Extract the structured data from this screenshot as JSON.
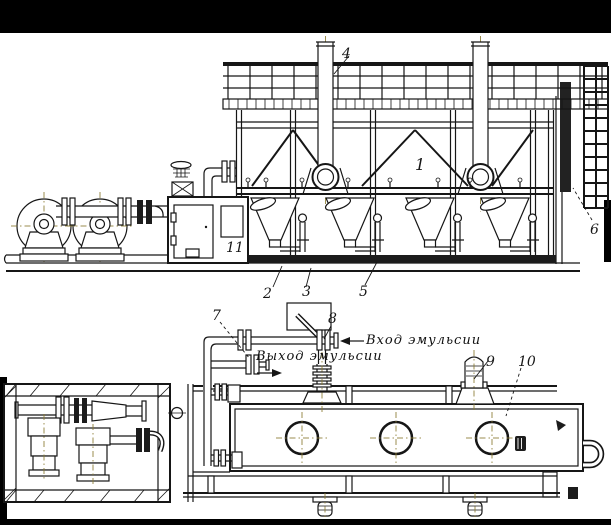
{
  "figure": {
    "type": "scanned-technical-drawing",
    "description": "Two-view engineering drawing of an emulsion cooling installation: side elevation (top) and plan view (bottom)",
    "callouts": [
      {
        "num": "1"
      },
      {
        "num": "2"
      },
      {
        "num": "3"
      },
      {
        "num": "4"
      },
      {
        "num": "5"
      },
      {
        "num": "6"
      },
      {
        "num": "7"
      },
      {
        "num": "8"
      },
      {
        "num": "9"
      },
      {
        "num": "10"
      },
      {
        "num": "11"
      }
    ],
    "annotations": {
      "inlet": "Вход эмульсии",
      "outlet": "Выход эмульсии"
    },
    "colors": {
      "ink": "#161616",
      "paper": "#ffffff",
      "scan_border": "#000000",
      "centerline": "#8a7a30"
    }
  }
}
